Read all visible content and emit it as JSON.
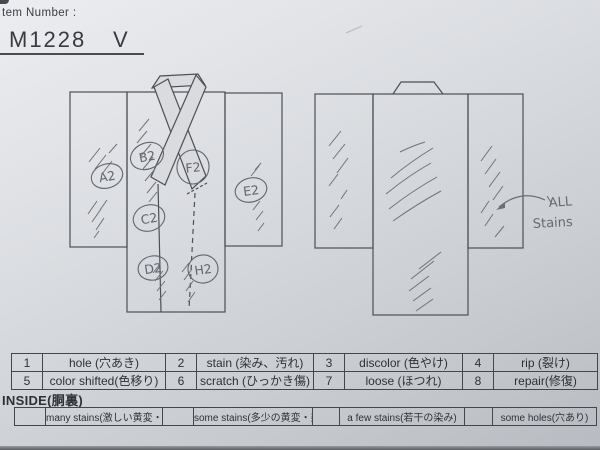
{
  "header": {
    "label": "tem Number :",
    "item_number": "M1228",
    "item_suffix": "V"
  },
  "diagram": {
    "front_markers": {
      "a": "A2",
      "b": "B2",
      "c": "C2",
      "d": "D2",
      "e": "E2",
      "f": "F2",
      "h": "H2"
    },
    "annotation": {
      "line1": "ALL",
      "line2": "Stains"
    }
  },
  "legend": {
    "items": [
      {
        "num": "1",
        "label": "hole (穴あき)"
      },
      {
        "num": "2",
        "label": "stain (染み、汚れ)"
      },
      {
        "num": "3",
        "label": "discolor (色やけ)"
      },
      {
        "num": "4",
        "label": "rip (裂け)"
      },
      {
        "num": "5",
        "label": "color shifted(色移り)"
      },
      {
        "num": "6",
        "label": "scratch (ひっかき傷)"
      },
      {
        "num": "7",
        "label": "loose (ほつれ)"
      },
      {
        "num": "8",
        "label": "repair(修復)"
      }
    ]
  },
  "inside": {
    "title": "INSIDE(胴裏)",
    "options": [
      "many stains(激しい黄変・染み)",
      "some stains(多少の黄変・染み)",
      "a few stains(若干の染み)",
      "some holes(穴あり)"
    ]
  },
  "colors": {
    "paper": "#d9dbdf",
    "ink": "#4e5058",
    "pencil": "#6b6d77"
  }
}
